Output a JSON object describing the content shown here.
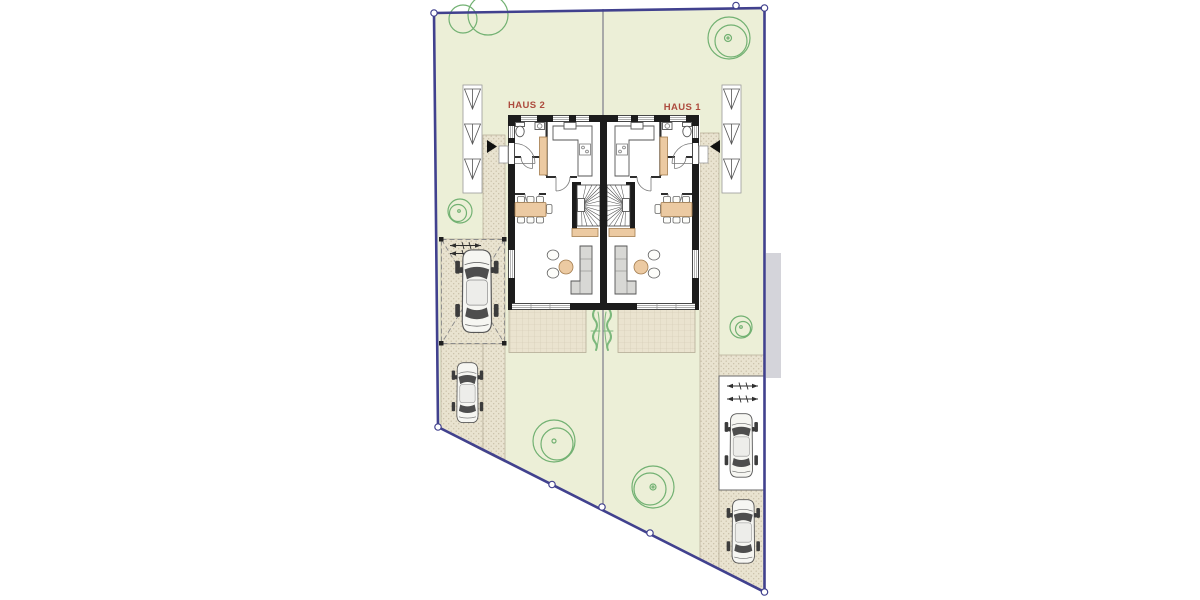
{
  "labels": {
    "house_left": "HAUS 2",
    "house_right": "HAUS 1"
  },
  "colors": {
    "boundary": "#41418e",
    "lawn": "#ecefd7",
    "paving": "#e9e3d0",
    "paving-dot": "#c6bda5",
    "terrace": "#eae3cf",
    "terrace-line": "#d2c9b2",
    "wall": "#1c1c1c",
    "wood": "#eccaa2",
    "wood-stroke": "#a37c4e",
    "sofa": "#d8d8d5",
    "tree": "#72b172",
    "plant": "#7cb87c",
    "label": "#ad4b3e",
    "offplot": "#d4d4da",
    "divider": "#63637a",
    "car-body": "#f6f6f2"
  }
}
